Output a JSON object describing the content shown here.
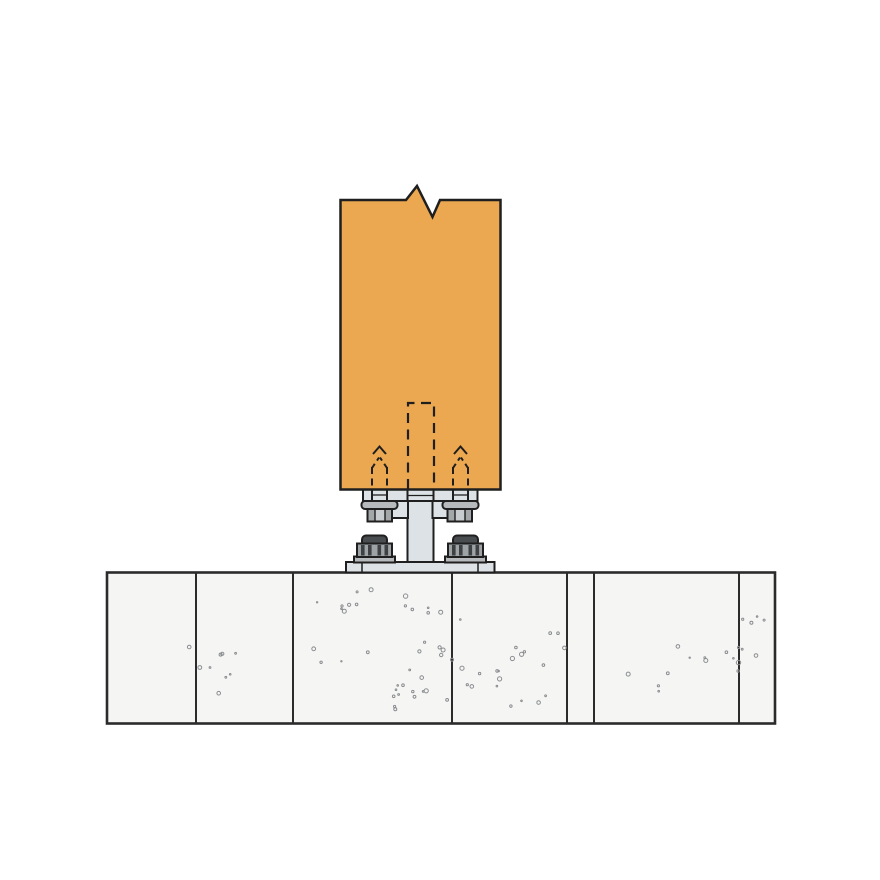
{
  "diagram": {
    "kind": "construction-connection-detail",
    "parts": [
      "wood-post",
      "post-break-symbol",
      "hidden-slot",
      "hidden-anchor-bolt-left",
      "hidden-anchor-bolt-right",
      "standoff-top-plate",
      "hex-bolt-left",
      "hex-bolt-right",
      "pedestal-stem",
      "base-plate",
      "anchor-nut-left",
      "anchor-nut-right",
      "concrete-foundation"
    ]
  },
  "colors": {
    "background": "#ffffff",
    "outline": "#1f1f1f",
    "post": "#ECA850",
    "steel": "#DDE2E6",
    "steel-mid": "#B7BABC",
    "steel-dark": "#A4A7A9",
    "hex-face": "#C9CCCE",
    "anchor-cap": "#4A4D50",
    "rib-dark": "#3E4043",
    "rib-light": "#9EA3A6",
    "concrete": "#F5F5F4",
    "concrete-line": "#2B2B2B",
    "speckle": "#8A8D90"
  },
  "foundation": {
    "top": 572.5,
    "bottom": 723.5,
    "left": 107,
    "right": 775,
    "joint_x": [
      196,
      293,
      452,
      567,
      594,
      739
    ],
    "speckle_seed": 11,
    "speckle_clusters": 16
  }
}
